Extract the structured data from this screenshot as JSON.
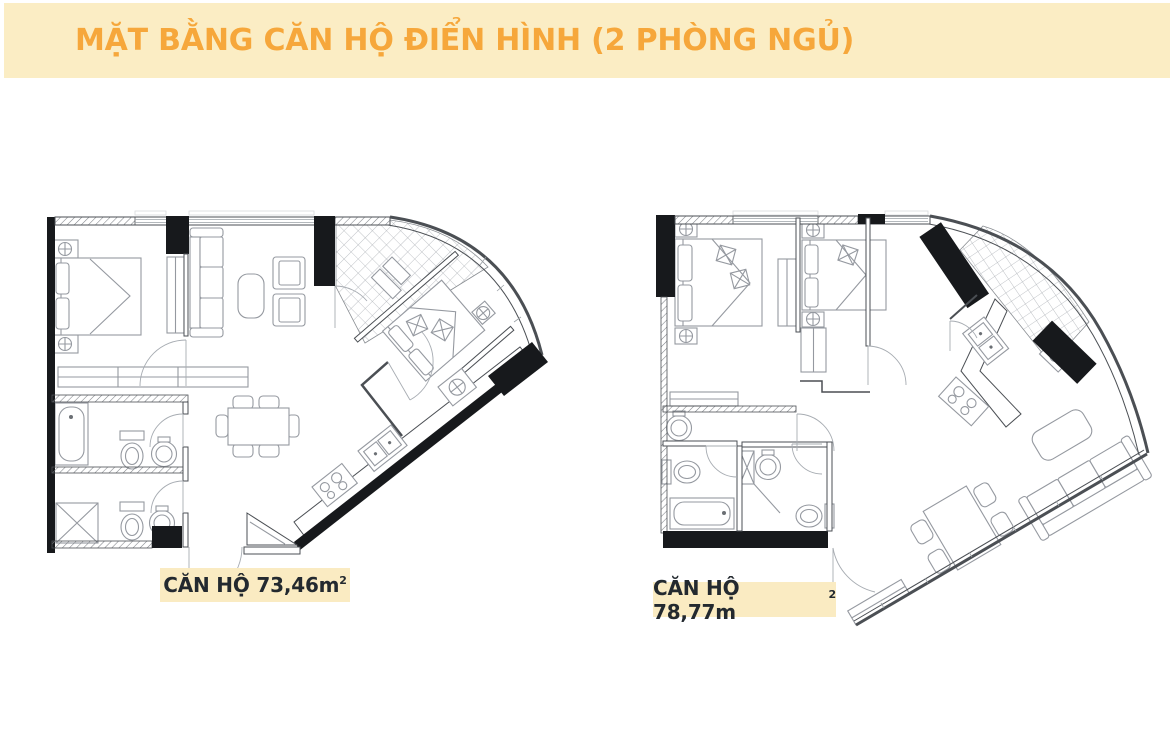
{
  "banner": {
    "title": "MẶT BẰNG CĂN HỘ ĐIỂN HÌNH (2 PHÒNG NGỦ)"
  },
  "plans": {
    "left": {
      "area_text": "CĂN HỘ 73,46m",
      "area_sup": "2"
    },
    "right": {
      "area_text": "CĂN HỘ 78,77m",
      "area_sup": "2"
    }
  },
  "colors": {
    "banner_bg": "#FBEDC4",
    "banner_text": "#F6A73B",
    "label_bg": "#FAEBC2",
    "label_text": "#23292F",
    "plan_wall": "#4B4F54",
    "plan_black": "#17191C",
    "plan_furn": "#9599A0"
  }
}
